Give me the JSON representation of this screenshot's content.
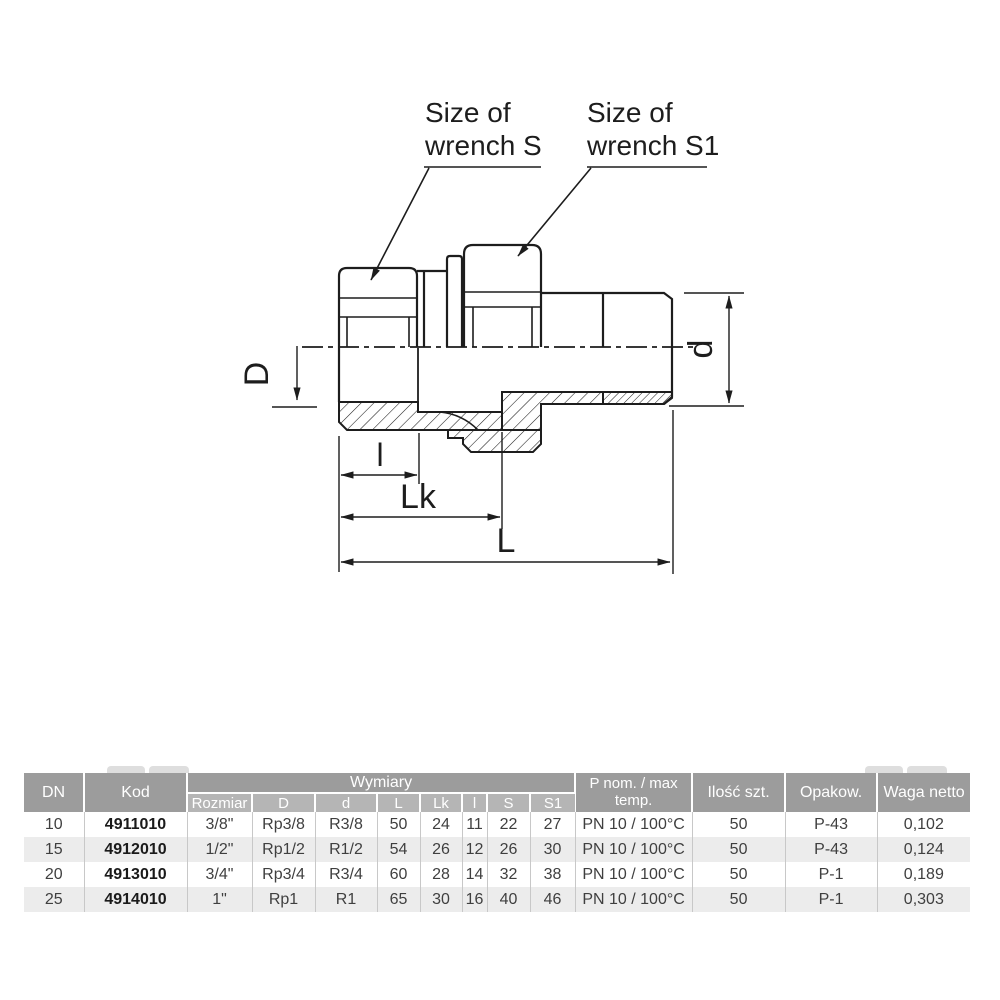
{
  "drawing": {
    "callouts": {
      "wrench_s": {
        "line1": "Size of",
        "line2": "wrench S"
      },
      "wrench_s1": {
        "line1": "Size of",
        "line2": "wrench S1"
      }
    },
    "dimensions": {
      "D": "D",
      "d": "d",
      "l": "l",
      "Lk": "Lk",
      "L": "L"
    },
    "line_color": "#1d1d1d"
  },
  "table": {
    "headers": {
      "dn": "DN",
      "kod": "Kod",
      "wymiary": "Wymiary",
      "sub": {
        "rozmiar": "Rozmiar",
        "D": "D",
        "d": "d",
        "L": "L",
        "Lk": "Lk",
        "l": "l",
        "S": "S",
        "S1": "S1"
      },
      "pnom": "P nom. / max temp.",
      "ilosc": "Ilość szt.",
      "opakow": "Opakow.",
      "waga": "Waga netto"
    },
    "rows": [
      {
        "dn": "10",
        "kod": "4911010",
        "rozmiar": "3/8\"",
        "D": "Rp3/8",
        "d": "R3/8",
        "L": "50",
        "Lk": "24",
        "l": "11",
        "S": "22",
        "S1": "27",
        "pnom": "PN 10 / 100°C",
        "ilosc": "50",
        "opakow": "P-43",
        "waga": "0,102"
      },
      {
        "dn": "15",
        "kod": "4912010",
        "rozmiar": "1/2\"",
        "D": "Rp1/2",
        "d": "R1/2",
        "L": "54",
        "Lk": "26",
        "l": "12",
        "S": "26",
        "S1": "30",
        "pnom": "PN 10 / 100°C",
        "ilosc": "50",
        "opakow": "P-43",
        "waga": "0,124"
      },
      {
        "dn": "20",
        "kod": "4913010",
        "rozmiar": "3/4\"",
        "D": "Rp3/4",
        "d": "R3/4",
        "L": "60",
        "Lk": "28",
        "l": "14",
        "S": "32",
        "S1": "38",
        "pnom": "PN 10 / 100°C",
        "ilosc": "50",
        "opakow": "P-1",
        "waga": "0,189"
      },
      {
        "dn": "25",
        "kod": "4914010",
        "rozmiar": "1\"",
        "D": "Rp1",
        "d": "R1",
        "L": "65",
        "Lk": "30",
        "l": "16",
        "S": "40",
        "S1": "46",
        "pnom": "PN 10 / 100°C",
        "ilosc": "50",
        "opakow": "P-1",
        "waga": "0,303"
      }
    ],
    "colors": {
      "header_bg": "#9c9c9c",
      "subheader_bg": "#b5b5b5",
      "stripe_bg": "#ececec",
      "header_text": "#ffffff"
    }
  }
}
